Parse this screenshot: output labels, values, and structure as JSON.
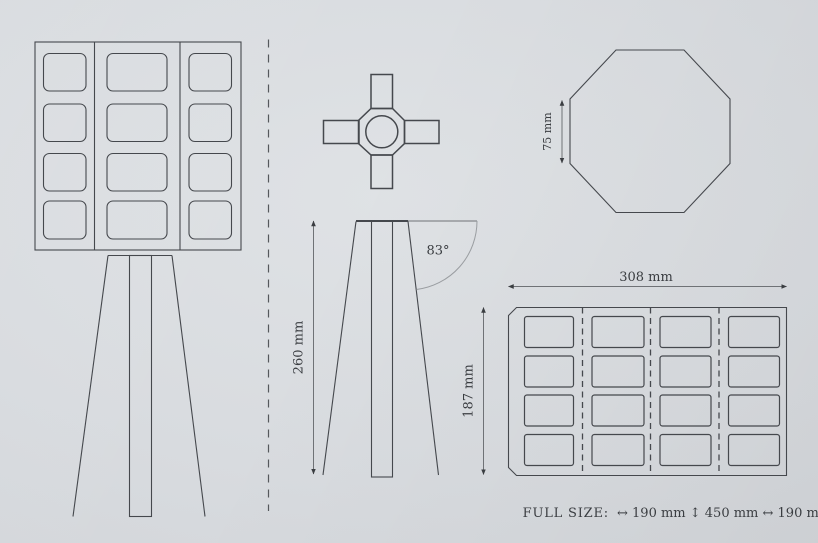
{
  "colors": {
    "background": "#d8dbdf",
    "line": "#45484d",
    "dim": "#6f7276",
    "arc": "#9a9da1",
    "sep": "#55585c",
    "text": "#3a3d41"
  },
  "views": {
    "front": {
      "description": "front view of lamp: 3x4 grid shade on tripod legs"
    },
    "top": {
      "description": "top view: cross hub with circle"
    },
    "octagon": {
      "width_label": "75 mm"
    },
    "side": {
      "height_label": "260 mm",
      "leg_label": "187 mm",
      "angle_label": "83°"
    },
    "panel": {
      "width_label": "308 mm"
    }
  },
  "footer": {
    "label": "FULL SIZE:",
    "value": "↔ 190 mm ↕ 450 mm ↔ 190 mm"
  }
}
